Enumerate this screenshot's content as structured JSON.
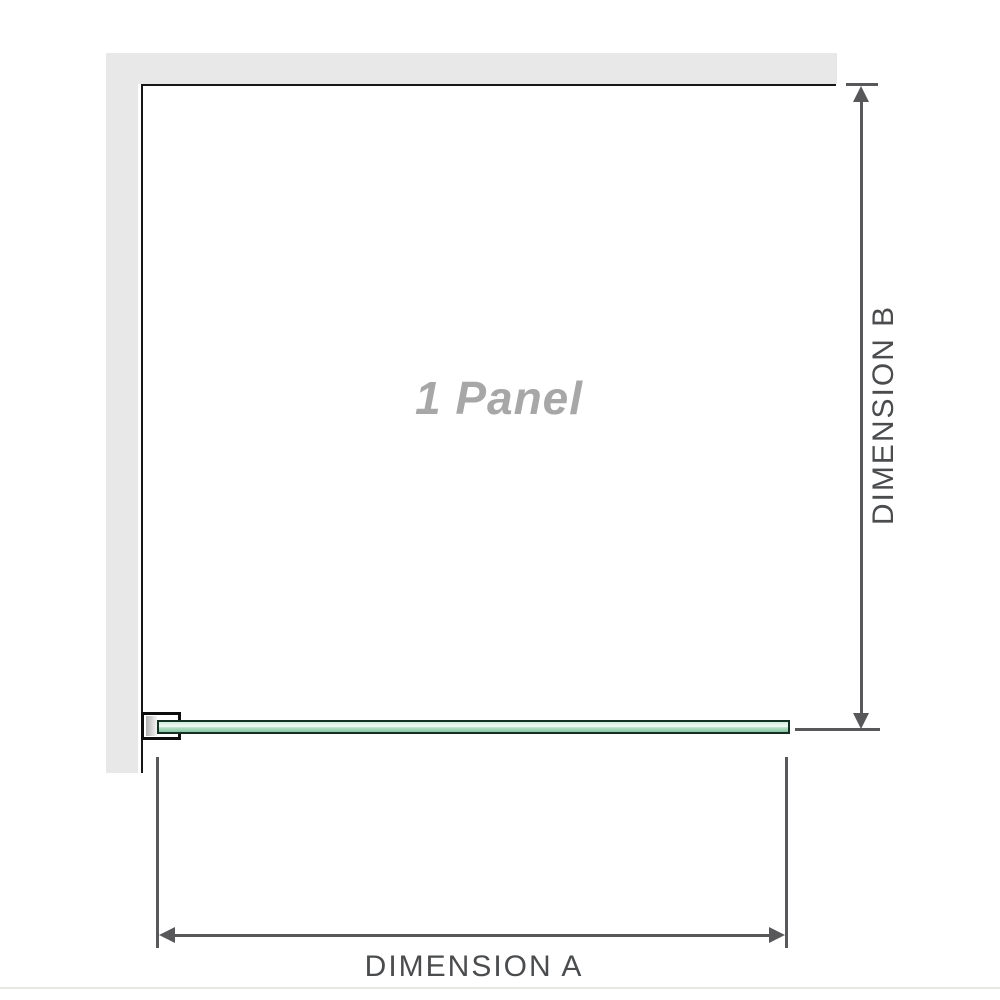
{
  "diagram": {
    "title": "1 Panel shower screen dimension diagram",
    "panel_label": "1 Panel",
    "dimension_a": {
      "label": "DIMENSION A",
      "orientation": "horizontal"
    },
    "dimension_b": {
      "label": "DIMENSION B",
      "orientation": "vertical"
    }
  },
  "colors": {
    "wall": "#e8e8e8",
    "outline": "#161616",
    "dimension": "#58585b",
    "dimension_text": "#4a4c4e",
    "panel_text": "#a7a7a7",
    "glass_light": "#cdebd9",
    "glass_mid": "#b2dec4",
    "glass_dark": "#86c5a1",
    "glass_border": "#143024",
    "page_rule": "#e9e7e1"
  }
}
